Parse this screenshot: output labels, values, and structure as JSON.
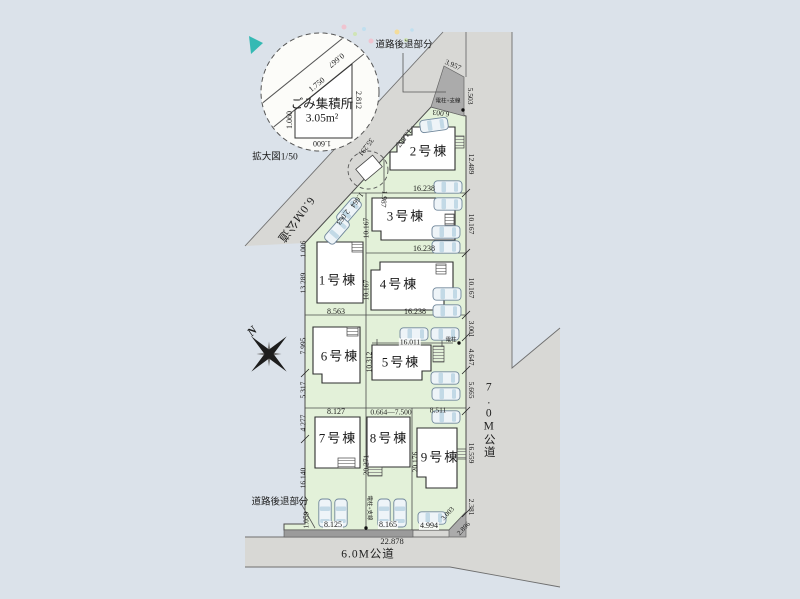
{
  "colors": {
    "background": "#dbe2ea",
    "road": "#d8d8d5",
    "road_edge": "#6f6f6f",
    "setback": "#ababab",
    "setback_dark": "#9b9b9b",
    "lot": "#e3f1d9",
    "lot_edge": "#4c4c4c",
    "building_fill": "#ffffff",
    "building_edge": "#2e2e2e",
    "car_body": "#eef4f8",
    "car_glass": "#c2d9e6",
    "car_edge": "#70879b",
    "text": "#1c1c1c",
    "accent_teal": "#18b2aa"
  },
  "labels": [
    {
      "id": "garbage-area-title",
      "text": "ごみ集積所",
      "x": 322,
      "y": 104,
      "size": 12.5
    },
    {
      "id": "garbage-area-size",
      "text": "3.05m²",
      "x": 322,
      "y": 119,
      "size": 11.5
    },
    {
      "id": "dim-1750",
      "text": "1.750",
      "x": 317,
      "y": 85,
      "rot": -39,
      "size": 8
    },
    {
      "id": "dim-2812",
      "text": "2.812",
      "x": 358,
      "y": 100,
      "rot": 90,
      "size": 8
    },
    {
      "id": "dim-1060",
      "text": "1.060",
      "x": 290,
      "y": 120,
      "rot": -90,
      "size": 8
    },
    {
      "id": "dim-1600",
      "text": "1.600",
      "x": 322,
      "y": 143,
      "rot": 180,
      "size": 8
    },
    {
      "id": "dim-0667",
      "text": "0.667",
      "x": 336,
      "y": 60,
      "rot": 141,
      "size": 8
    },
    {
      "id": "detail-scale-label",
      "text": "拡大図1/50",
      "x": 275,
      "y": 158,
      "size": 9.5
    },
    {
      "id": "setback-label-top",
      "text": "道路後退部分",
      "x": 404,
      "y": 46,
      "size": 9.5
    },
    {
      "id": "dim-3957",
      "text": "3.957",
      "x": 453,
      "y": 65,
      "rot": 24,
      "size": 7.5
    },
    {
      "id": "dim-5503",
      "text": "5.503",
      "x": 470,
      "y": 96,
      "rot": 90,
      "size": 7.5
    },
    {
      "id": "pole-label-top",
      "text": "電柱+支線",
      "x": 448,
      "y": 102,
      "size": 5.5
    },
    {
      "id": "dim-6003",
      "text": "6.003",
      "x": 441,
      "y": 113,
      "rot": 187,
      "size": 7.5
    },
    {
      "id": "dim-12489",
      "text": "12.489",
      "x": 471,
      "y": 164,
      "rot": 90,
      "size": 7.5
    },
    {
      "id": "dim-13567",
      "text": "13.567",
      "x": 404,
      "y": 138,
      "rot": 127,
      "size": 7.5
    },
    {
      "id": "dim-35291",
      "text": "35.291",
      "x": 366,
      "y": 147,
      "rot": 127,
      "size": 7.5
    },
    {
      "id": "road-label-diagonal",
      "text": "6.0M公道",
      "x": 295,
      "y": 219,
      "rot": 127,
      "size": 11.5,
      "cls": "road-lbl"
    },
    {
      "id": "dim-1987",
      "text": "1.987",
      "x": 384,
      "y": 199,
      "rot": 95,
      "size": 7.5
    },
    {
      "id": "dim-1664",
      "text": "1.664",
      "x": 357,
      "y": 200,
      "rot": 127,
      "size": 7.5
    },
    {
      "id": "dim-2063",
      "text": "2.063",
      "x": 343,
      "y": 217,
      "rot": 127,
      "size": 7.5
    },
    {
      "id": "dim-16238-top",
      "text": "16.238",
      "x": 424,
      "y": 189,
      "size": 8
    },
    {
      "id": "dim-16238-mid",
      "text": "16.238",
      "x": 424,
      "y": 249,
      "size": 8
    },
    {
      "id": "dim-16238-bottom",
      "text": "16.238",
      "x": 415,
      "y": 312,
      "size": 8
    },
    {
      "id": "dim-8563",
      "text": "8.563",
      "x": 336,
      "y": 312,
      "size": 8
    },
    {
      "id": "dim-10167-w3",
      "text": "10.167",
      "x": 366,
      "y": 228,
      "rot": -90,
      "size": 7.5
    },
    {
      "id": "dim-10167-e3",
      "text": "10.167",
      "x": 471,
      "y": 224,
      "rot": 90,
      "size": 7.5
    },
    {
      "id": "dim-10167-w4",
      "text": "10.167",
      "x": 366,
      "y": 290,
      "rot": -90,
      "size": 7.5
    },
    {
      "id": "dim-10167-e4",
      "text": "10.167",
      "x": 471,
      "y": 288,
      "rot": 90,
      "size": 7.5
    },
    {
      "id": "dim-1006",
      "text": "1.006",
      "x": 303,
      "y": 249,
      "rot": -90,
      "size": 7.5
    },
    {
      "id": "dim-13289",
      "text": "13.289",
      "x": 303,
      "y": 283,
      "rot": -90,
      "size": 7.5
    },
    {
      "id": "dim-7995",
      "text": "7.995",
      "x": 303,
      "y": 346,
      "rot": -90,
      "size": 7.5
    },
    {
      "id": "dim-5317",
      "text": "5.317",
      "x": 303,
      "y": 390,
      "rot": -90,
      "size": 7.5
    },
    {
      "id": "dim-16011",
      "text": "16.011",
      "x": 410,
      "y": 342,
      "size": 7.5,
      "cls": "bgw"
    },
    {
      "id": "dim-10312",
      "text": "10.312",
      "x": 369,
      "y": 362,
      "rot": -90,
      "size": 7.5
    },
    {
      "id": "dim-3001",
      "text": "3.001",
      "x": 471,
      "y": 329,
      "rot": 90,
      "size": 7.5
    },
    {
      "id": "dim-4647",
      "text": "4.647",
      "x": 471,
      "y": 357,
      "rot": 90,
      "size": 7.5
    },
    {
      "id": "dim-5665",
      "text": "5.665",
      "x": 471,
      "y": 390,
      "rot": 90,
      "size": 7.5
    },
    {
      "id": "pole-label-mid",
      "text": "電柱",
      "x": 451,
      "y": 341,
      "size": 5.5
    },
    {
      "id": "road-label-right",
      "text": "7.0M公道",
      "x": 488,
      "y": 420,
      "size": 11.5,
      "cls": "vtext road-lbl"
    },
    {
      "id": "dim-4277",
      "text": "4.277",
      "x": 303,
      "y": 423,
      "rot": -90,
      "size": 7.5
    },
    {
      "id": "dim-16140",
      "text": "16.140",
      "x": 303,
      "y": 478,
      "rot": -90,
      "size": 7.5
    },
    {
      "id": "dim-1059",
      "text": "1.059",
      "x": 306,
      "y": 520,
      "rot": -90,
      "size": 7.5
    },
    {
      "id": "setback-label-bottom",
      "text": "道路後退部分",
      "x": 280,
      "y": 503,
      "size": 9.5
    },
    {
      "id": "dim-8127",
      "text": "8.127",
      "x": 336,
      "y": 412,
      "size": 8
    },
    {
      "id": "dim-0664-7500",
      "text": "0.664—7.500",
      "x": 391,
      "y": 412,
      "size": 7.5
    },
    {
      "id": "dim-8511",
      "text": "8.511",
      "x": 438,
      "y": 410,
      "size": 7.5
    },
    {
      "id": "dim-20271",
      "text": "20.271",
      "x": 366,
      "y": 465,
      "rot": -90,
      "size": 7.5
    },
    {
      "id": "dim-20176",
      "text": "20.176",
      "x": 415,
      "y": 462,
      "rot": -90,
      "size": 7.5
    },
    {
      "id": "dim-16559",
      "text": "16.559",
      "x": 471,
      "y": 453,
      "rot": 90,
      "size": 7.5
    },
    {
      "id": "dim-2381",
      "text": "2.381",
      "x": 471,
      "y": 507,
      "rot": 90,
      "size": 7.5
    },
    {
      "id": "pole-label-bottom",
      "text": "電柱+支線",
      "x": 368,
      "y": 508,
      "rot": 90,
      "size": 5.5
    },
    {
      "id": "dim-8125",
      "text": "8.125",
      "x": 333,
      "y": 525,
      "size": 8,
      "cls": "bgw"
    },
    {
      "id": "dim-8165",
      "text": "8.165",
      "x": 388,
      "y": 525,
      "size": 8,
      "cls": "bgw"
    },
    {
      "id": "dim-4994",
      "text": "4.994",
      "x": 429,
      "y": 526,
      "size": 8,
      "cls": "bgw"
    },
    {
      "id": "dim-3003",
      "text": "3.003",
      "x": 448,
      "y": 514,
      "rot": -47,
      "size": 7
    },
    {
      "id": "dim-2896",
      "text": "2.896",
      "x": 464,
      "y": 529,
      "rot": -47,
      "size": 7
    },
    {
      "id": "dim-22878",
      "text": "22.878",
      "x": 392,
      "y": 541,
      "size": 8.5
    },
    {
      "id": "road-label-bottom",
      "text": "6.0M公道",
      "x": 368,
      "y": 555,
      "size": 11.5,
      "cls": "road-lbl"
    },
    {
      "id": "compass-n-label",
      "text": "N",
      "x": 252,
      "y": 331,
      "rot": -45,
      "size": 12,
      "cls": "compass-n"
    },
    {
      "id": "building-1-label",
      "text": "1号棟",
      "x": 338,
      "y": 280,
      "size": 13,
      "cls": "bldg"
    },
    {
      "id": "building-2-label",
      "text": "2号棟",
      "x": 429,
      "y": 151,
      "size": 13,
      "cls": "bldg"
    },
    {
      "id": "building-3-label",
      "text": "3号棟",
      "x": 406,
      "y": 216,
      "size": 13,
      "cls": "bldg"
    },
    {
      "id": "building-4-label",
      "text": "4号棟",
      "x": 399,
      "y": 284,
      "size": 13,
      "cls": "bldg"
    },
    {
      "id": "building-5-label",
      "text": "5号棟",
      "x": 401,
      "y": 362,
      "size": 13,
      "cls": "bldg"
    },
    {
      "id": "building-6-label",
      "text": "6号棟",
      "x": 340,
      "y": 356,
      "size": 13,
      "cls": "bldg"
    },
    {
      "id": "building-7-label",
      "text": "7号棟",
      "x": 338,
      "y": 438,
      "size": 13,
      "cls": "bldg"
    },
    {
      "id": "building-8-label",
      "text": "8号棟",
      "x": 389,
      "y": 438,
      "size": 13,
      "cls": "bldg"
    },
    {
      "id": "building-9-label",
      "text": "9号棟",
      "x": 440,
      "y": 457,
      "size": 13,
      "cls": "bldg"
    }
  ],
  "cars": [
    {
      "x": 349,
      "y": 211,
      "rot": -49
    },
    {
      "x": 337,
      "y": 231,
      "rot": -49
    },
    {
      "x": 434,
      "y": 125,
      "rot": -8
    },
    {
      "x": 448,
      "y": 187
    },
    {
      "x": 448,
      "y": 204
    },
    {
      "x": 446,
      "y": 232
    },
    {
      "x": 446,
      "y": 247
    },
    {
      "x": 447,
      "y": 294
    },
    {
      "x": 447,
      "y": 311
    },
    {
      "x": 414,
      "y": 334
    },
    {
      "x": 445,
      "y": 334
    },
    {
      "x": 445,
      "y": 378
    },
    {
      "x": 446,
      "y": 394
    },
    {
      "x": 446,
      "y": 417
    },
    {
      "x": 432,
      "y": 518
    },
    {
      "x": 325,
      "y": 513,
      "rot": 90
    },
    {
      "x": 341,
      "y": 513,
      "rot": 90
    },
    {
      "x": 384,
      "y": 513,
      "rot": 90
    },
    {
      "x": 400,
      "y": 513,
      "rot": 90
    }
  ]
}
